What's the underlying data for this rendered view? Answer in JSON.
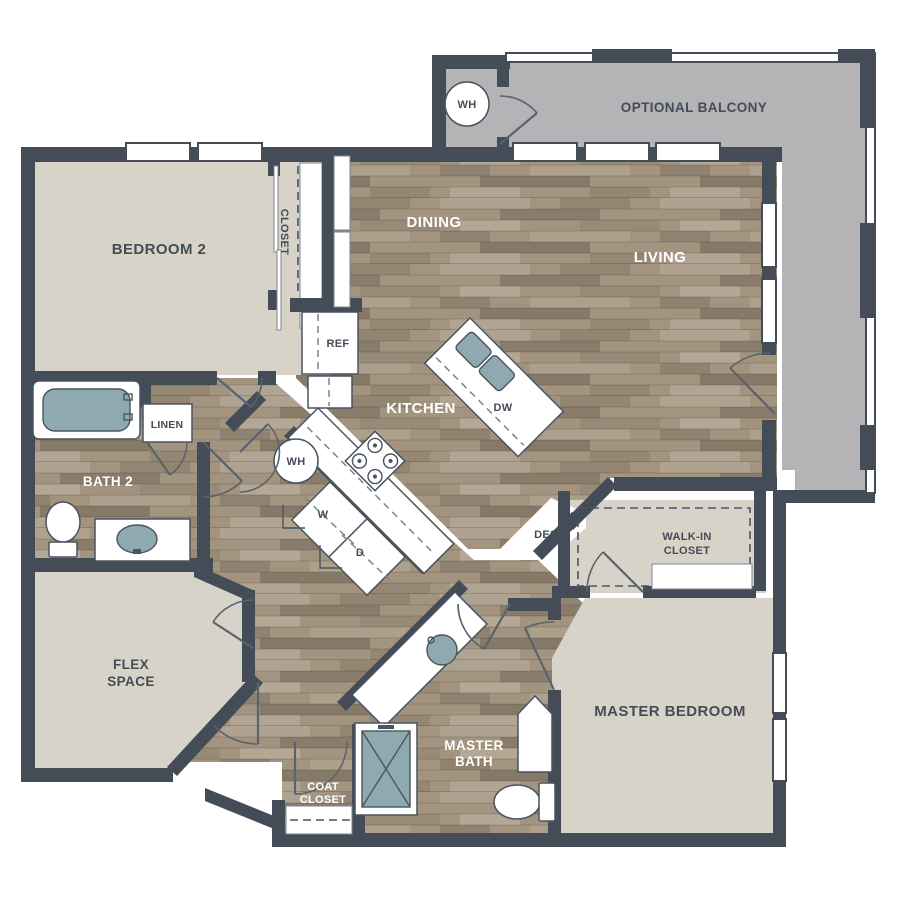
{
  "title": "Apartment Floor Plan",
  "colors": {
    "wall": "#434c57",
    "carpet": "#d8d3c9",
    "wood": "#a3947f",
    "balcony": "#b4b4b6",
    "fixture": "#8fa9b1",
    "line": "#4a545f",
    "label_dark": "#434c57",
    "label_light": "#ffffff"
  },
  "labels": {
    "bedroom2": "BEDROOM 2",
    "closet": "CLOSET",
    "dining": "DINING",
    "living": "LIVING",
    "kitchen": "KITCHEN",
    "optional_balcony": "OPTIONAL BALCONY",
    "wh_balcony": "WH",
    "wh_hall": "WH",
    "ref": "REF",
    "dw": "DW",
    "washer": "W",
    "dryer": "D",
    "linen": "LINEN",
    "bath2": "BATH 2",
    "flex1": "FLEX",
    "flex2": "SPACE",
    "desk": "DESK",
    "walkin1": "WALK-IN",
    "walkin2": "CLOSET",
    "master_bedroom": "MASTER BEDROOM",
    "master_bath1": "MASTER",
    "master_bath2": "BATH",
    "coat1": "COAT",
    "coat2": "CLOSET"
  }
}
